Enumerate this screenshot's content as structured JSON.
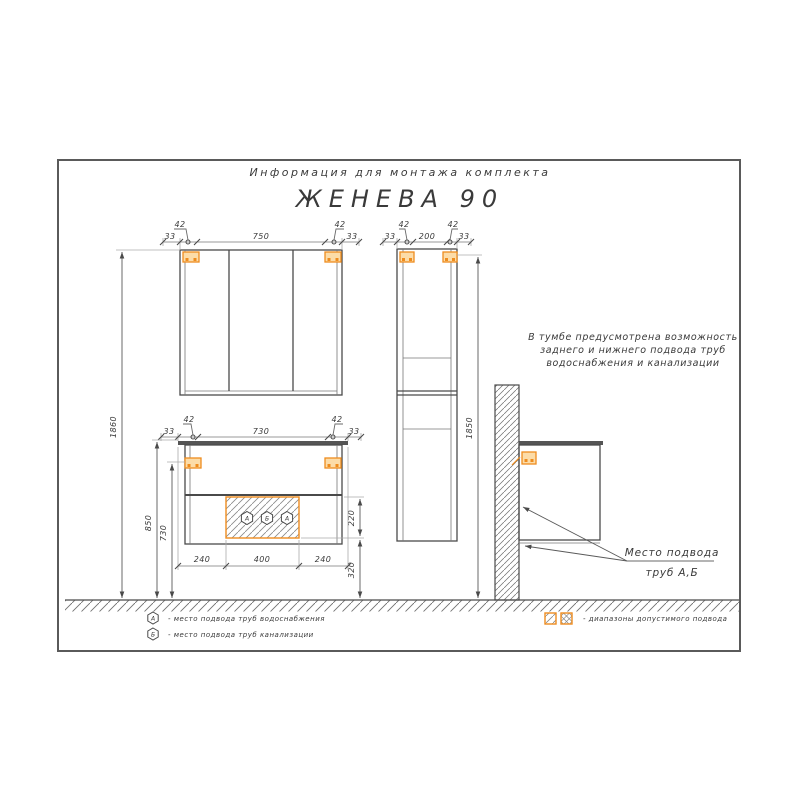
{
  "title": {
    "subtitle": "Информация для монтажа комплекта",
    "product": "ЖЕНЕВА 90"
  },
  "note": {
    "line1": "В тумбе предусмотрена возможность",
    "line2": "заднего и нижнего подвода труб",
    "line3": "водоснабжения и канализации"
  },
  "pipes_callout": {
    "line1": "Место подвода",
    "line2": "труб А,Б"
  },
  "mirror": {
    "dim_42_left": "42",
    "dim_42_right": "42",
    "dim_33_left": "33",
    "dim_33_right": "33",
    "dim_width": "750",
    "dim_height": "1860"
  },
  "vanity": {
    "dim_42_left": "42",
    "dim_42_right": "42",
    "dim_33_left": "33",
    "dim_33_right": "33",
    "dim_width": "730",
    "dim_height_top": "850",
    "dim_height_bracket": "730",
    "dim_bottom_left": "240",
    "dim_bottom_center": "400",
    "dim_bottom_right": "240",
    "dim_zone_height": "220",
    "dim_zone_floor": "320",
    "port_1": "А",
    "port_2": "Б",
    "port_3": "А"
  },
  "tall_cabinet": {
    "dim_42_left": "42",
    "dim_42_right": "42",
    "dim_33_left": "33",
    "dim_33_right": "33",
    "dim_width": "200",
    "dim_height": "1850"
  },
  "legend": {
    "water_symbol": "А",
    "water_text": "- место подвода труб водоснабжения",
    "sewer_symbol": "Б",
    "sewer_text": "- место подвода труб канализации",
    "zones_text": "- диапазоны допустимого подвода"
  },
  "colors": {
    "accent": "#EE8C1E",
    "accent_fill": "#FCDCA8",
    "line_dark": "#4A4A4A",
    "line_light": "#9A9A9A"
  }
}
